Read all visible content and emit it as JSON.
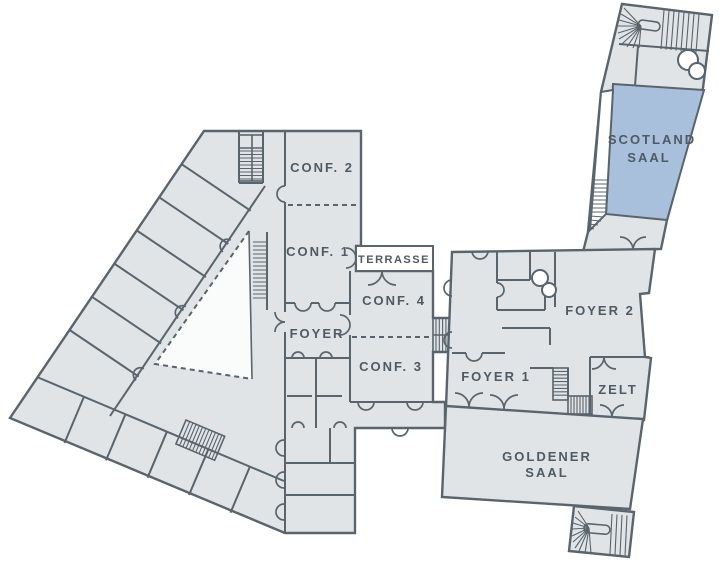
{
  "plan": {
    "type": "venue-floor-plan",
    "highlighted_room": "SCOTLAND SAAL",
    "colors": {
      "wall": "#59646d",
      "room_fill": "#e1e4e6",
      "highlight_fill": "#a9c0dc",
      "courtyard_fill": "#fafbfb",
      "terrace_fill": "#ffffff",
      "label": "#4e5a64",
      "background": "#ffffff"
    }
  },
  "rooms": {
    "conf2": {
      "label": "CONF. 2"
    },
    "conf1": {
      "label": "CONF. 1"
    },
    "terrasse": {
      "label": "TERRASSE"
    },
    "conf4": {
      "label": "CONF. 4"
    },
    "foyer": {
      "label": "FOYER"
    },
    "conf3": {
      "label": "CONF. 3"
    },
    "foyer1": {
      "label": "FOYER 1"
    },
    "foyer2": {
      "label": "FOYER 2"
    },
    "zelt": {
      "label": "ZELT"
    },
    "goldener_saal": {
      "label_line1": "GOLDENER",
      "label_line2": "SAAL"
    },
    "scotland_saal": {
      "label_line1": "SCOTLAND",
      "label_line2": "SAAL",
      "highlighted": true
    }
  }
}
